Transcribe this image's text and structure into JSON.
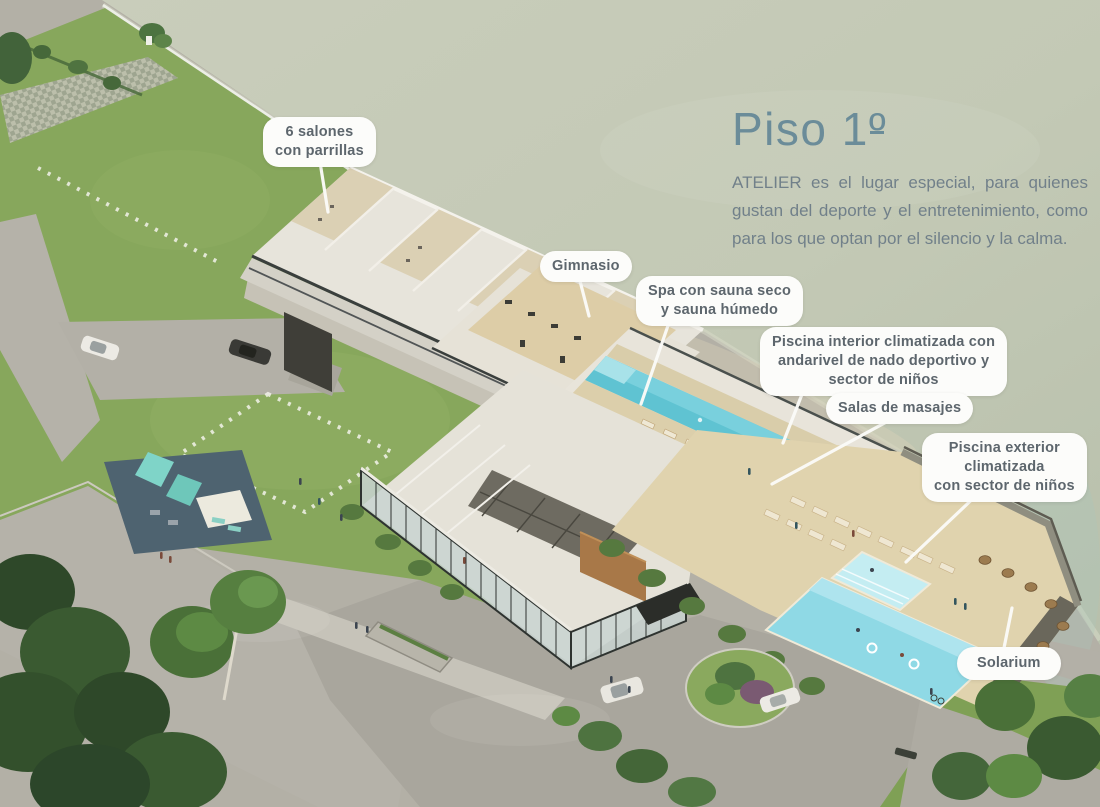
{
  "header": {
    "title_text": "Piso 1",
    "title_ordinal": "º",
    "description": "ATELIER es el lugar especial, para quienes gustan del deporte y el entretenimiento, como para los que optan por el silencio y la calma."
  },
  "callouts": [
    {
      "id": "salones-parrillas",
      "label": "6 salones\ncon parrillas"
    },
    {
      "id": "gimnasio",
      "label": "Gimnasio"
    },
    {
      "id": "spa",
      "label": "Spa con sauna seco\ny sauna húmedo"
    },
    {
      "id": "piscina-interior",
      "label": "Piscina interior climatizada con\nandarivel de nado deportivo y\nsector de niños"
    },
    {
      "id": "salas-masajes",
      "label": "Salas de masajes"
    },
    {
      "id": "piscina-exterior",
      "label": "Piscina exterior\nclimatizada\ncon sector de niños"
    },
    {
      "id": "solarium",
      "label": "Solarium"
    }
  ],
  "colors": {
    "title": "#6b8c99",
    "body": "#71808a",
    "bubble-bg": "#fcfcfa",
    "bubble-text": "#5d666d",
    "leader": "#fbfbf8",
    "water": "#c5cab7",
    "grass": "#87a75c",
    "pool-indoor": "#5fc3d2",
    "pool-outdoor": "#8fd9e5",
    "deck": "#dfd3ae",
    "wood-panel": "#a87848",
    "glass-frame": "#343a37"
  }
}
